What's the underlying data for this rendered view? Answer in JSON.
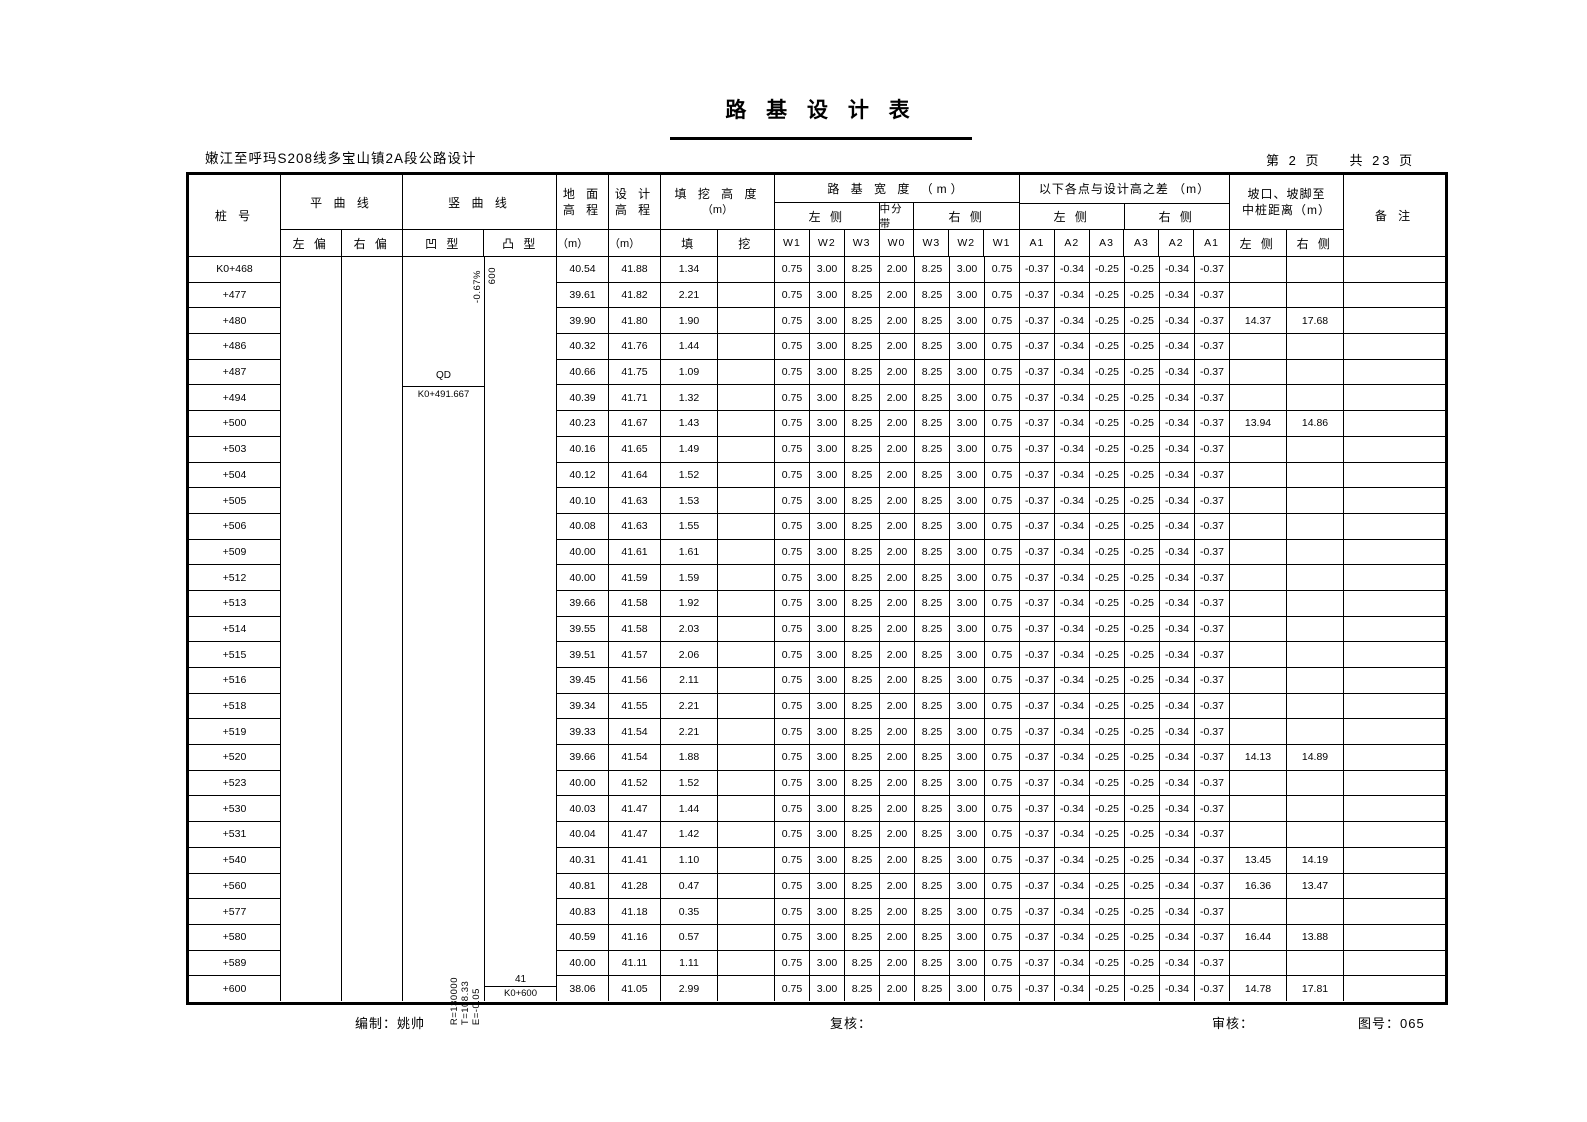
{
  "title": "路 基 设 计 表",
  "subtitle": "嫩江至呼玛S208线多宝山镇2A段公路设计",
  "pagination": {
    "current": "第 2 页",
    "total": "共 23 页"
  },
  "header": {
    "station": "桩 号",
    "hcurve": "平 曲 线",
    "hcurve_left": "左 偏",
    "hcurve_right": "右 偏",
    "vcurve": "竖 曲 线",
    "vcurve_concave": "凹 型",
    "vcurve_convex": "凸 型",
    "ground_l1": "地 面",
    "ground_l2": "高 程",
    "design_l1": "设 计",
    "design_l2": "高 程",
    "unit_m": "（m）",
    "fillcut_l1": "填 挖 高 度",
    "fillcut_l2": "（m）",
    "fill": "填",
    "cut": "挖",
    "width_group": "路 基 宽 度 （m）",
    "left_side": "左 侧",
    "median": "中分带",
    "right_side": "右 侧",
    "w_labels": [
      "W1",
      "W2",
      "W3",
      "W0",
      "W3",
      "W2",
      "W1"
    ],
    "diff_group": "以下各点与设计高之差 （m）",
    "a_labels": [
      "A1",
      "A2",
      "A3",
      "A3",
      "A2",
      "A1"
    ],
    "slope_l1": "坡口、坡脚至",
    "slope_l2": "中桩距离（m）",
    "dist_left": "左 侧",
    "dist_right": "右 侧",
    "remark": "备 注"
  },
  "row_constants": {
    "widths": [
      "0.75",
      "3.00",
      "8.25",
      "2.00",
      "8.25",
      "3.00",
      "0.75"
    ],
    "diffs": [
      "-0.37",
      "-0.34",
      "-0.25",
      "-0.25",
      "-0.34",
      "-0.37"
    ]
  },
  "rows": [
    {
      "station": "K0+468",
      "ground": "40.54",
      "design": "41.88",
      "fill": "1.34",
      "cut": "",
      "dist_left": "",
      "dist_right": ""
    },
    {
      "station": "+477",
      "ground": "39.61",
      "design": "41.82",
      "fill": "2.21",
      "cut": "",
      "dist_left": "",
      "dist_right": ""
    },
    {
      "station": "+480",
      "ground": "39.90",
      "design": "41.80",
      "fill": "1.90",
      "cut": "",
      "dist_left": "14.37",
      "dist_right": "17.68"
    },
    {
      "station": "+486",
      "ground": "40.32",
      "design": "41.76",
      "fill": "1.44",
      "cut": "",
      "dist_left": "",
      "dist_right": ""
    },
    {
      "station": "+487",
      "ground": "40.66",
      "design": "41.75",
      "fill": "1.09",
      "cut": "",
      "dist_left": "",
      "dist_right": ""
    },
    {
      "station": "+494",
      "ground": "40.39",
      "design": "41.71",
      "fill": "1.32",
      "cut": "",
      "dist_left": "",
      "dist_right": ""
    },
    {
      "station": "+500",
      "ground": "40.23",
      "design": "41.67",
      "fill": "1.43",
      "cut": "",
      "dist_left": "13.94",
      "dist_right": "14.86"
    },
    {
      "station": "+503",
      "ground": "40.16",
      "design": "41.65",
      "fill": "1.49",
      "cut": "",
      "dist_left": "",
      "dist_right": ""
    },
    {
      "station": "+504",
      "ground": "40.12",
      "design": "41.64",
      "fill": "1.52",
      "cut": "",
      "dist_left": "",
      "dist_right": ""
    },
    {
      "station": "+505",
      "ground": "40.10",
      "design": "41.63",
      "fill": "1.53",
      "cut": "",
      "dist_left": "",
      "dist_right": ""
    },
    {
      "station": "+506",
      "ground": "40.08",
      "design": "41.63",
      "fill": "1.55",
      "cut": "",
      "dist_left": "",
      "dist_right": ""
    },
    {
      "station": "+509",
      "ground": "40.00",
      "design": "41.61",
      "fill": "1.61",
      "cut": "",
      "dist_left": "",
      "dist_right": ""
    },
    {
      "station": "+512",
      "ground": "40.00",
      "design": "41.59",
      "fill": "1.59",
      "cut": "",
      "dist_left": "",
      "dist_right": ""
    },
    {
      "station": "+513",
      "ground": "39.66",
      "design": "41.58",
      "fill": "1.92",
      "cut": "",
      "dist_left": "",
      "dist_right": ""
    },
    {
      "station": "+514",
      "ground": "39.55",
      "design": "41.58",
      "fill": "2.03",
      "cut": "",
      "dist_left": "",
      "dist_right": ""
    },
    {
      "station": "+515",
      "ground": "39.51",
      "design": "41.57",
      "fill": "2.06",
      "cut": "",
      "dist_left": "",
      "dist_right": ""
    },
    {
      "station": "+516",
      "ground": "39.45",
      "design": "41.56",
      "fill": "2.11",
      "cut": "",
      "dist_left": "",
      "dist_right": ""
    },
    {
      "station": "+518",
      "ground": "39.34",
      "design": "41.55",
      "fill": "2.21",
      "cut": "",
      "dist_left": "",
      "dist_right": ""
    },
    {
      "station": "+519",
      "ground": "39.33",
      "design": "41.54",
      "fill": "2.21",
      "cut": "",
      "dist_left": "",
      "dist_right": ""
    },
    {
      "station": "+520",
      "ground": "39.66",
      "design": "41.54",
      "fill": "1.88",
      "cut": "",
      "dist_left": "14.13",
      "dist_right": "14.89"
    },
    {
      "station": "+523",
      "ground": "40.00",
      "design": "41.52",
      "fill": "1.52",
      "cut": "",
      "dist_left": "",
      "dist_right": ""
    },
    {
      "station": "+530",
      "ground": "40.03",
      "design": "41.47",
      "fill": "1.44",
      "cut": "",
      "dist_left": "",
      "dist_right": ""
    },
    {
      "station": "+531",
      "ground": "40.04",
      "design": "41.47",
      "fill": "1.42",
      "cut": "",
      "dist_left": "",
      "dist_right": ""
    },
    {
      "station": "+540",
      "ground": "40.31",
      "design": "41.41",
      "fill": "1.10",
      "cut": "",
      "dist_left": "13.45",
      "dist_right": "14.19"
    },
    {
      "station": "+560",
      "ground": "40.81",
      "design": "41.28",
      "fill": "0.47",
      "cut": "",
      "dist_left": "16.36",
      "dist_right": "13.47"
    },
    {
      "station": "+577",
      "ground": "40.83",
      "design": "41.18",
      "fill": "0.35",
      "cut": "",
      "dist_left": "",
      "dist_right": ""
    },
    {
      "station": "+580",
      "ground": "40.59",
      "design": "41.16",
      "fill": "0.57",
      "cut": "",
      "dist_left": "16.44",
      "dist_right": "13.88"
    },
    {
      "station": "+589",
      "ground": "40.00",
      "design": "41.11",
      "fill": "1.11",
      "cut": "",
      "dist_left": "",
      "dist_right": ""
    },
    {
      "station": "+600",
      "ground": "38.06",
      "design": "41.05",
      "fill": "2.99",
      "cut": "",
      "dist_left": "14.78",
      "dist_right": "17.81"
    }
  ],
  "vcurve_annotations": {
    "grade": "-0.67%",
    "curve_length": "600",
    "start_mark": "QD",
    "start_station": "K0+491.667",
    "radius": "R=130000",
    "tangent": "T=108.33",
    "external": "E=-0.05",
    "end_elevation": "41",
    "end_station": "K0+600"
  },
  "footer": {
    "prepared": "编制：姚帅",
    "check": "复核：",
    "review": "审核：",
    "drawing_no": "图号：065"
  }
}
